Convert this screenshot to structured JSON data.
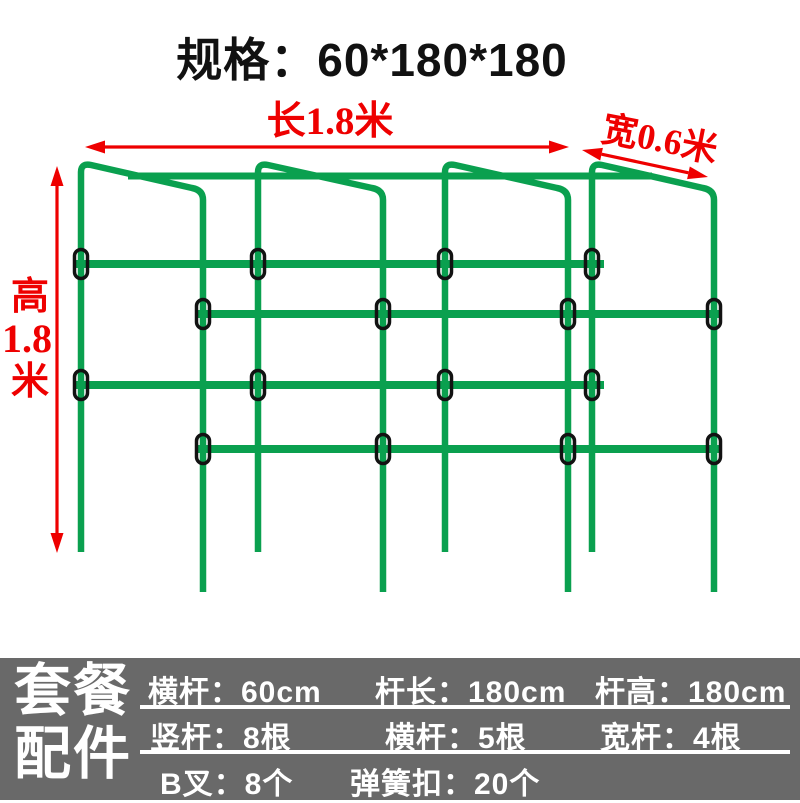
{
  "title": "规格：60*180*180",
  "diagram": {
    "colors": {
      "green": "#0aa04f",
      "red": "#ee0000",
      "clip_stroke": "#121212"
    },
    "front_posts_x": [
      81,
      258,
      445,
      592
    ],
    "back_posts_x": [
      203,
      383,
      568,
      714
    ],
    "front_top_y": 163,
    "front_bottom_y": 552,
    "back_top_y": 191,
    "back_bottom_y": 592,
    "top_bar": {
      "y": 176,
      "x1": 128,
      "x2": 652
    },
    "rows": [
      {
        "y": 264,
        "plane": "front",
        "x1": 75,
        "x2": 604
      },
      {
        "y": 314,
        "plane": "back",
        "x1": 197,
        "x2": 722
      },
      {
        "y": 385,
        "plane": "front",
        "x1": 75,
        "x2": 604
      },
      {
        "y": 449,
        "plane": "back",
        "x1": 197,
        "x2": 722
      }
    ],
    "arrows": {
      "length": {
        "x1": 85,
        "y1": 147,
        "x2": 569,
        "y2": 147
      },
      "width": {
        "x1": 582,
        "y1": 150,
        "x2": 708,
        "y2": 177
      },
      "height": {
        "x1": 57,
        "y1": 166,
        "x2": 57,
        "y2": 553
      }
    },
    "labels": {
      "length": "长1.8米",
      "width": "宽0.6米",
      "height_line1": "高",
      "height_line2": "1.8",
      "height_line3": "米"
    }
  },
  "spec_panel": {
    "background": "#696969",
    "label": "套餐\n配件",
    "rows": [
      {
        "cells": [
          "横杆：60cm",
          "杆长：180cm",
          "杆高：180cm"
        ]
      },
      {
        "cells": [
          "竖杆：8根",
          "横杆：5根",
          "宽杆：4根"
        ]
      },
      {
        "cells": [
          "B叉：8个",
          "弹簧扣：20个"
        ]
      }
    ]
  }
}
